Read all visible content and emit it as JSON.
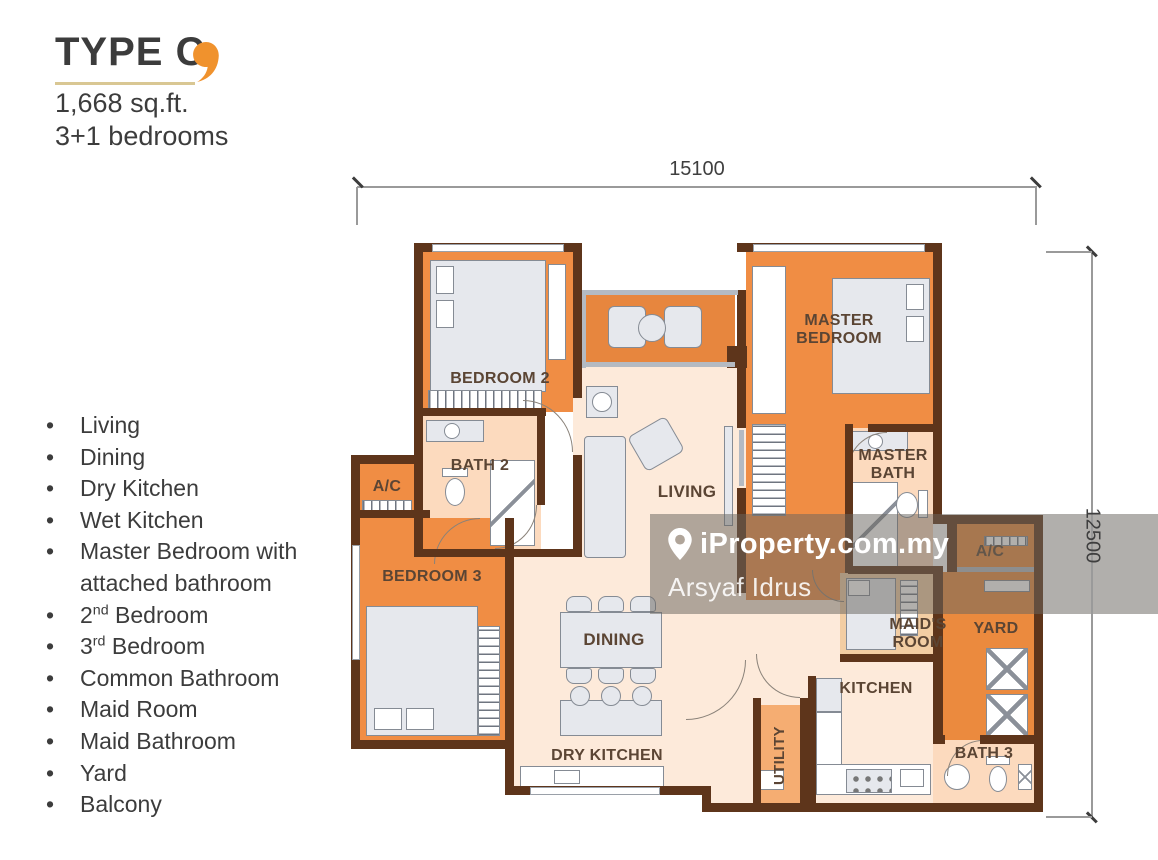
{
  "header": {
    "title": "TYPE C",
    "area": "1,668 sq.ft.",
    "bedrooms": "3+1 bedrooms"
  },
  "features": [
    [
      {
        "t": "Living"
      }
    ],
    [
      {
        "t": "Dining"
      }
    ],
    [
      {
        "t": "Dry Kitchen"
      }
    ],
    [
      {
        "t": "Wet Kitchen"
      }
    ],
    [
      {
        "t": "Master Bedroom with attached bathroom"
      }
    ],
    [
      {
        "t": "2"
      },
      {
        "sup": "nd"
      },
      {
        "t": " Bedroom"
      }
    ],
    [
      {
        "t": "3"
      },
      {
        "sup": "rd"
      },
      {
        "t": " Bedroom"
      }
    ],
    [
      {
        "t": "Common Bathroom"
      }
    ],
    [
      {
        "t": "Maid Room"
      }
    ],
    [
      {
        "t": "Maid Bathroom"
      }
    ],
    [
      {
        "t": "Yard"
      }
    ],
    [
      {
        "t": "Balcony"
      }
    ]
  ],
  "plan": {
    "dim_width": "15100",
    "dim_height": "12500",
    "rooms": {
      "bedroom2": "BEDROOM 2",
      "bath2": "BATH 2",
      "ac_left": "A/C",
      "bedroom3": "BEDROOM 3",
      "living": "LIVING",
      "dining": "DINING",
      "dry_kitchen": "DRY KITCHEN",
      "master_bedroom": "MASTER BEDROOM",
      "master_bath": "MASTER BATH",
      "ac_right": "A/C",
      "maids_room": "MAID'S ROOM",
      "yard": "YARD",
      "kitchen": "KITCHEN",
      "utility": "UTILITY",
      "bath3": "BATH 3"
    }
  },
  "watermark": {
    "brand": "iProperty.com.my",
    "agent": "Arsyaf Idrus"
  },
  "icons": {
    "title_accent": "comma-icon",
    "watermark_pin": "location-pin-icon"
  },
  "colors": {
    "accent_orange": "#f0922d",
    "room_orange": "#f08d44",
    "wall_brown": "#5e351b",
    "floor_cream": "#fdeada",
    "floor_peach": "#fcdabe",
    "maid_tan": "#f2cda3",
    "watermark_overlay": "rgba(106,101,96,0.52)"
  }
}
